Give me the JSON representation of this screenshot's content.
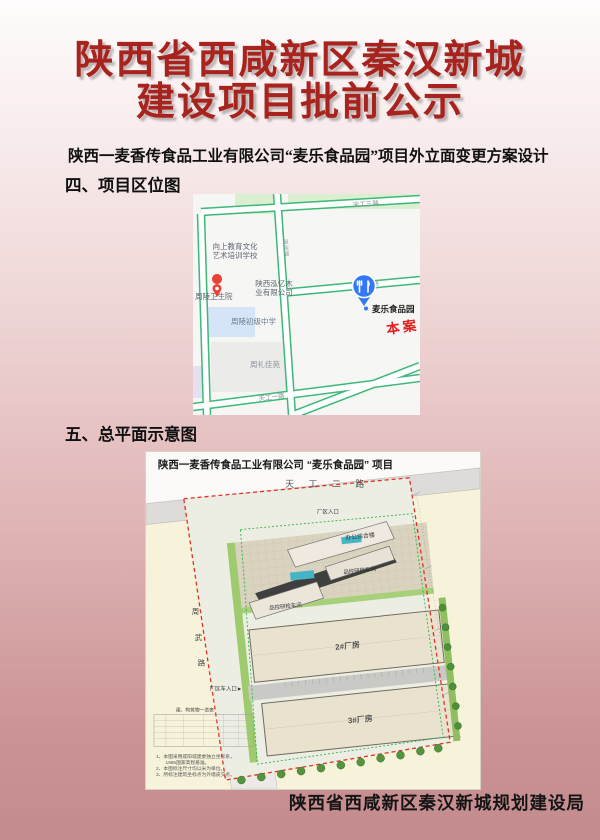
{
  "page": {
    "title_line1": "陕西省西咸新区秦汉新城",
    "title_line2": "建设项目批前公示",
    "subtitle": "陕西一麦香传食品工业有限公司“麦乐食品园”项目外立面变更方案设计",
    "section4_heading": "四、项目区位图",
    "section5_heading": "五、总平面示意图",
    "footer": "陕西省西咸新区秦汉新城规划建设局"
  },
  "colors": {
    "title_red": "#a8231d",
    "map_road_green": "#3cb878",
    "pin_blue": "#3478f6",
    "pin_red": "#ea4335",
    "case_red": "#e01f1f",
    "boundary_red": "#e53020",
    "boundary_green": "#2db34a"
  },
  "location_map": {
    "roads": {
      "top": "天工三路",
      "middle": "天工二路",
      "bottom": "天工一路",
      "vertical": "周武路"
    },
    "pois": [
      {
        "name_line1": "向上教育文化",
        "name_line2": "艺术培训学校"
      },
      {
        "name_line1": "陕西泓亿木",
        "name_line2": "业有限公司"
      },
      {
        "name_line1": "周陵卫生院"
      },
      {
        "name_line1": "周陵初级中学"
      },
      {
        "name_line1": "周礼佳苑"
      },
      {
        "name_line1": "麦乐食品园"
      }
    ],
    "case_label": "本案"
  },
  "site_plan": {
    "title": "陕西一麦香传食品工业有限公司 “麦乐食品园” 项目",
    "road_top": "天 工 二 路",
    "road_left_char1": "周",
    "road_left_char2": "武",
    "road_left_char3": "路",
    "entrance_top": "厂区入口",
    "entrance_side": "厂区车入口►",
    "building_office": "办公综合楼",
    "building_qc1": "品控研检车间",
    "building_qc2": "品控研检车间",
    "building_wh2": "2#厂房",
    "building_wh3": "3#厂房",
    "table_title": "建、构筑物一览表",
    "notes": [
      "1、本图采用咸阳城建委独立坐标系，",
      "　　1985国家高程基准。",
      "2、本图标注尺寸均以米为单位。",
      "3、所标注建筑坐标点为外墙皮交点。"
    ]
  }
}
